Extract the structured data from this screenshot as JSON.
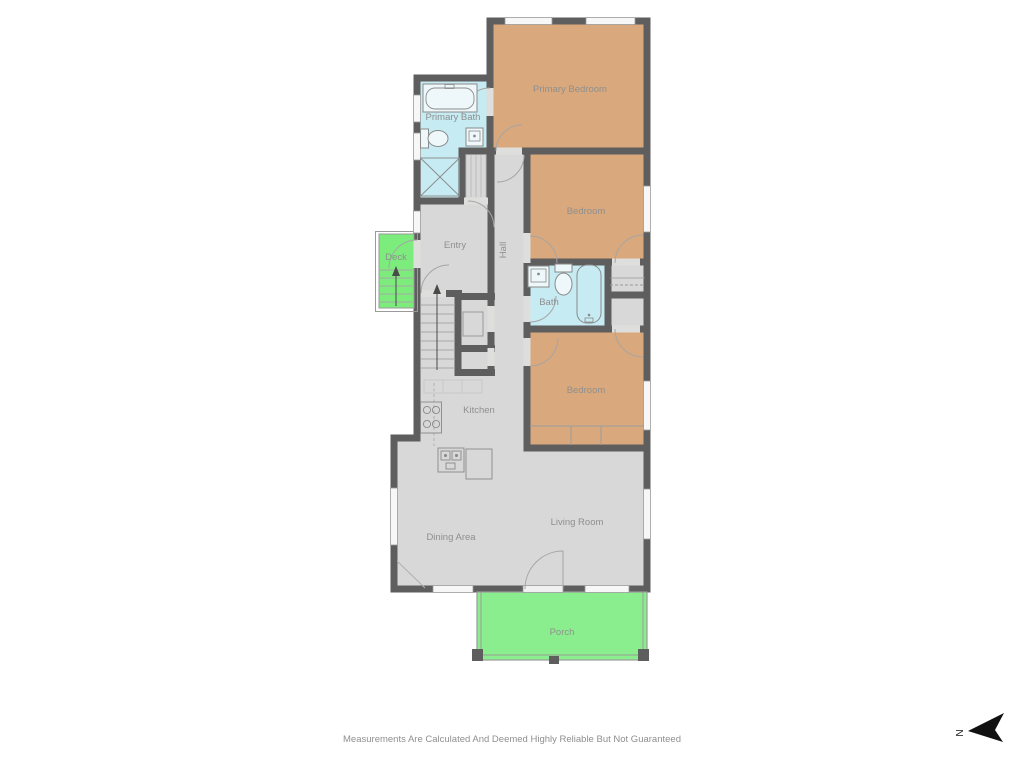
{
  "plan": {
    "rooms": [
      {
        "name": "Primary Bedroom",
        "type": "bedroom"
      },
      {
        "name": "Primary Bath",
        "type": "bath"
      },
      {
        "name": "Bedroom",
        "type": "bedroom"
      },
      {
        "name": "Bath",
        "type": "bath"
      },
      {
        "name": "Bedroom",
        "type": "bedroom"
      },
      {
        "name": "Entry",
        "type": "interior"
      },
      {
        "name": "Hall",
        "type": "interior"
      },
      {
        "name": "Deck",
        "type": "outdoor"
      },
      {
        "name": "Kitchen",
        "type": "interior"
      },
      {
        "name": "Dining Area",
        "type": "interior"
      },
      {
        "name": "Living Room",
        "type": "interior"
      },
      {
        "name": "Porch",
        "type": "outdoor"
      }
    ],
    "colors": {
      "wall": "#5e5e5e",
      "bedroom": "#d9a87c",
      "bath": "#c6ebf2",
      "interior": "#d8d8d8",
      "deck": "#7ced7c",
      "porch": "#8bee8e",
      "label": "#8f8f8f",
      "line": "#9a9a9a",
      "compass": "#111111"
    },
    "compass": {
      "label": "N",
      "direction": "left"
    },
    "disclaimer": "Measurements Are Calculated And Deemed Highly Reliable But Not Guaranteed"
  }
}
